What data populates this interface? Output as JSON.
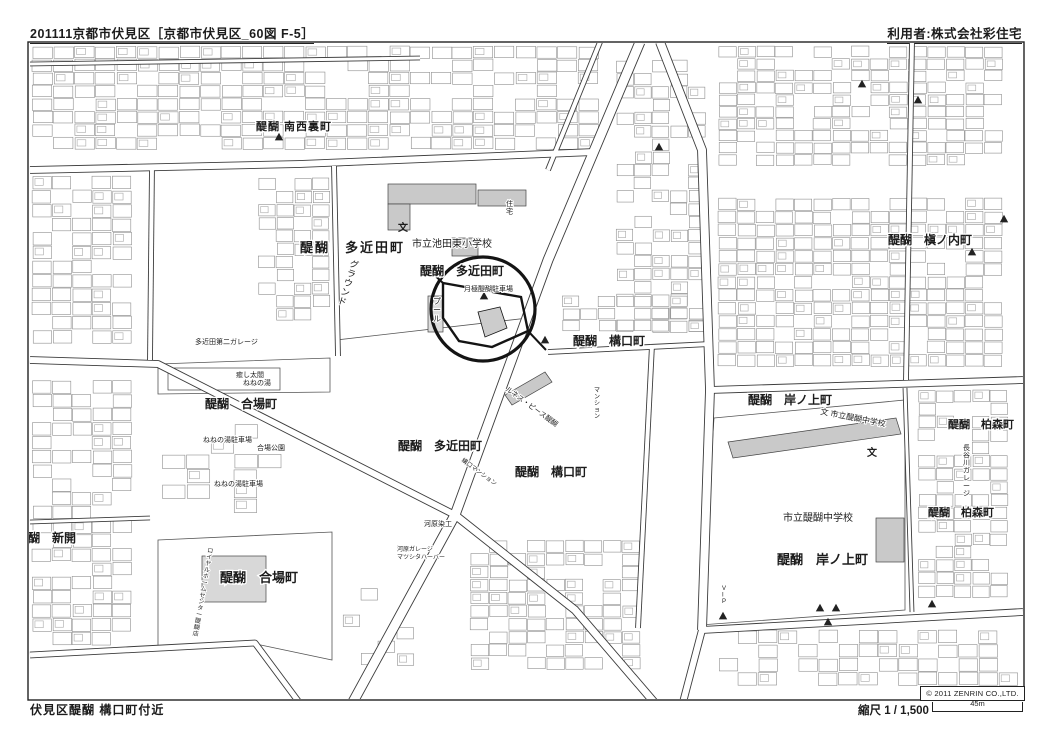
{
  "page": {
    "header_left": "201111京都市伏見区［京都市伏見区_60図 F-5］",
    "header_right": "利用者:株式会社彩住宅",
    "footer_left": "伏見区醍醐 構口町付近",
    "scale_label": "縮尺 1 / 1,500",
    "scale_bar_label": "45m",
    "copyright": "© 2011 ZENRIN CO.,LTD."
  },
  "colors": {
    "ink": "#1c1c1c",
    "road_casing": "#3c3c3c",
    "parcel_line": "#8f8f8f",
    "building_fill": "#c9c9c9",
    "highlight": "#141414"
  },
  "map": {
    "labels": [
      {
        "t": "醍醐 南西裏町",
        "x": 256,
        "y": 130,
        "s": 11,
        "ls": 1,
        "w": 700
      },
      {
        "t": "醍醐　多近田町",
        "x": 300,
        "y": 252,
        "s": 13,
        "ls": 2,
        "w": 700
      },
      {
        "t": "市立池田東小学校",
        "x": 412,
        "y": 247,
        "s": 10
      },
      {
        "t": "醍醐　多近田町",
        "x": 420,
        "y": 275,
        "s": 12,
        "w": 700
      },
      {
        "t": "グラウンド",
        "x": 349,
        "y": 266,
        "s": 9,
        "v": 1,
        "r": 18
      },
      {
        "t": "プール",
        "x": 433,
        "y": 304,
        "s": 8,
        "v": 1
      },
      {
        "t": "月極醍醐駐車場",
        "x": 464,
        "y": 291,
        "s": 7
      },
      {
        "t": "醍醐　構口町",
        "x": 573,
        "y": 345,
        "s": 12,
        "w": 700
      },
      {
        "t": "多近田第二ガレージ",
        "x": 195,
        "y": 344,
        "s": 7
      },
      {
        "t": "癒し太閤",
        "x": 236,
        "y": 377,
        "s": 7
      },
      {
        "t": "ねねの湯",
        "x": 243,
        "y": 385,
        "s": 7
      },
      {
        "t": "醍醐　合場町",
        "x": 205,
        "y": 408,
        "s": 12,
        "w": 700
      },
      {
        "t": "ねねの湯駐車場",
        "x": 203,
        "y": 442,
        "s": 7
      },
      {
        "t": "合場公園",
        "x": 257,
        "y": 450,
        "s": 7
      },
      {
        "t": "ねねの湯駐車場",
        "x": 214,
        "y": 486,
        "s": 7
      },
      {
        "t": "醍醐　多近田町",
        "x": 398,
        "y": 450,
        "s": 12,
        "w": 700
      },
      {
        "t": "醍醐　構口町",
        "x": 515,
        "y": 476,
        "s": 12,
        "w": 700
      },
      {
        "t": "構口マンション",
        "x": 461,
        "y": 461,
        "s": 6,
        "r": 36
      },
      {
        "t": "ルネス・ピース醍醐",
        "x": 505,
        "y": 390,
        "s": 7,
        "r": 36
      },
      {
        "t": "マンション",
        "x": 594,
        "y": 392,
        "s": 6,
        "v": 1
      },
      {
        "t": "住宅",
        "x": 506,
        "y": 206,
        "s": 7,
        "v": 1
      },
      {
        "t": "醍醐　岸ノ上町",
        "x": 748,
        "y": 404,
        "s": 12,
        "w": 700
      },
      {
        "t": "文 市立醍醐中学校",
        "x": 820,
        "y": 414,
        "s": 8,
        "r": 11
      },
      {
        "t": "市立醍醐中学校",
        "x": 783,
        "y": 521,
        "s": 10
      },
      {
        "t": "醍醐　岸ノ上町",
        "x": 777,
        "y": 564,
        "s": 13,
        "w": 700
      },
      {
        "t": "醍醐　柏森町",
        "x": 948,
        "y": 428,
        "s": 11,
        "w": 700
      },
      {
        "t": "醍醐　柏森町",
        "x": 928,
        "y": 516,
        "s": 11,
        "w": 700
      },
      {
        "t": "長谷川ガレージ",
        "x": 963,
        "y": 450,
        "s": 7,
        "v": 1
      },
      {
        "t": "醍醐　槇ノ内町",
        "x": 888,
        "y": 244,
        "s": 12,
        "w": 700
      },
      {
        "t": "醍醐　新開",
        "x": 16,
        "y": 542,
        "s": 12,
        "w": 700
      },
      {
        "t": "ロイヤルホームセンター醍醐店",
        "x": 207,
        "y": 552,
        "s": 6,
        "v": 1,
        "r": 10
      },
      {
        "t": "醍醐　合場町",
        "x": 220,
        "y": 582,
        "s": 13,
        "w": 700
      },
      {
        "t": "河原染工",
        "x": 424,
        "y": 526,
        "s": 7
      },
      {
        "t": "河原ガレージ",
        "x": 397,
        "y": 551,
        "s": 6
      },
      {
        "t": "マツシタハーバー",
        "x": 397,
        "y": 559,
        "s": 6
      },
      {
        "t": "VIP",
        "x": 722,
        "y": 590,
        "s": 6,
        "v": 1
      }
    ],
    "symbols": {
      "triangle_markers": [
        [
          279,
          137
        ],
        [
          484,
          296
        ],
        [
          545,
          340
        ],
        [
          972,
          252
        ],
        [
          862,
          84
        ],
        [
          918,
          100
        ],
        [
          659,
          147
        ],
        [
          820,
          608
        ],
        [
          836,
          608
        ],
        [
          828,
          622
        ],
        [
          723,
          616
        ],
        [
          1004,
          219
        ],
        [
          932,
          604
        ]
      ],
      "school_symbols": [
        [
          403,
          227
        ],
        [
          872,
          452
        ]
      ]
    }
  }
}
